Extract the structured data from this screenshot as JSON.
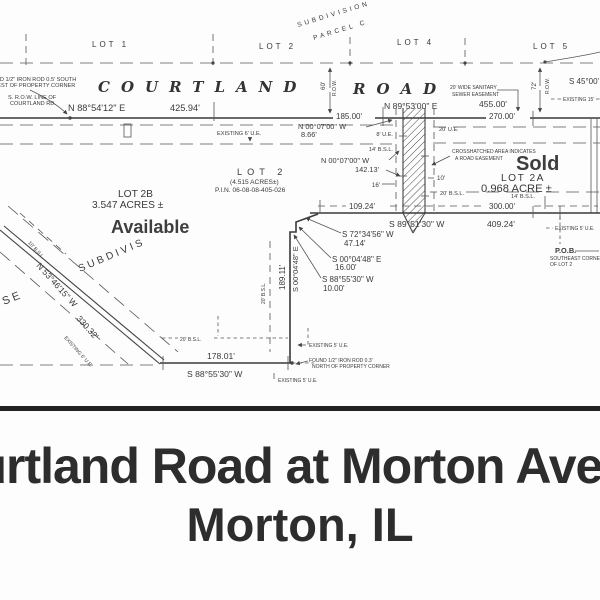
{
  "banner": {
    "line1": "Courtland Road at Morton Avenue",
    "line2": "Morton, IL"
  },
  "colors": {
    "ink": "#3a3a3a",
    "overlay_text": "#3e3e3e",
    "banner_text": "#2d2d2d",
    "paper": "#fdfdfd"
  },
  "plat": {
    "adjacent_lots": {
      "lot1": "LOT 1",
      "lot2": "LOT 2",
      "lot4": "LOT 4",
      "lot5": "LOT 5"
    },
    "subdivision_note": {
      "line1": "SUBDIVISION",
      "line2": "PARCEL C"
    },
    "road_name": {
      "left": "COURTLAND",
      "right": "ROAD"
    },
    "corner_note_nw": {
      "l1": "FOUND 1/2\" IRON ROD 0.5' SOUTH",
      "l2": "WEST OF PROPERTY CORNER",
      "l3": "S. R.O.W. LINE OF",
      "l4": "COURTLAND RD."
    },
    "row_dims": {
      "left_w": "60'",
      "left_t": "R.O.W.",
      "right_w": "72'",
      "right_t": "R.O.W."
    },
    "north_line": {
      "brg_left": "N 88°54'12\" E",
      "dist_left": "425.94'",
      "brg_right": "N 89°53'00\" E",
      "dist_right": "455.00'",
      "dist_185": "185.00'",
      "dist_270": "270.00'"
    },
    "se45": "S 45°00'",
    "existing_15": "EXISTING 15'",
    "sewer_easement": {
      "l1": "20' WIDE SANITARY",
      "l2": "SEWER EASEMENT"
    },
    "existing_6_top": "EXISTING 6' U.E.",
    "jog": {
      "brg": "N 00°07'00\" W",
      "dist": "8.66'"
    },
    "west_easement_line": {
      "brg": "N 00°07'00\" W",
      "dist": "142.13'"
    },
    "strip_labels": {
      "ue8": "8' U.E.",
      "bsl14_left": "14' B.S.L.",
      "ue20": "20' U.E.",
      "d10": "10'",
      "d16": "16'",
      "bsl20_right": "20' B.S.L."
    },
    "crosshatch_note": {
      "l1": "CROSSHATCHED AREA INDICATES",
      "l2": "A ROAD EASEMENT"
    },
    "lot2b": {
      "name": "LOT 2B",
      "acres": "3.547 ACRES ±",
      "status": "Available"
    },
    "lot2": {
      "name": "LOT 2",
      "acres": "(4.515 ACRES±)",
      "pin": "P.I.N. 06-08-08-405-026"
    },
    "lot2a": {
      "status": "Sold",
      "name": "LOT 2A",
      "acres": "0.968 ACRE ±",
      "bsl14": "14' B.S.L."
    },
    "south_line_2a": {
      "dist_109": "109.24'",
      "dist_300": "300.00'",
      "brg": "S 89°51'30\" W",
      "dist": "409.24'"
    },
    "existing_5_east": "EXISTING 5' U.E.",
    "pob": {
      "l1": "P.O.B.",
      "l2": "SOUTHEAST CORNER",
      "l3": "OF LOT 2"
    },
    "step_calls": [
      {
        "brg": "S 72°34'56\" W",
        "dist": "47.14'"
      },
      {
        "brg": "S 00°04'48\" E",
        "dist": "16.00'"
      },
      {
        "brg": "S 88°55'30\" W",
        "dist": "10.00'"
      }
    ],
    "west_line": {
      "dist": "189.11'",
      "brg": "S 00°04'48\" E",
      "bsl": "20' B.S.L."
    },
    "south_line_2b": {
      "dist": "178.01'",
      "brg": "S 88°55'30\" W",
      "bsl": "20' B.S.L."
    },
    "corner_note_s": {
      "ue_a": "EXISTING 5' U.E.",
      "rod1": "FOUND 1/2\" IRON ROD 0.3'",
      "rod2": "NORTH OF PROPERTY CORNER",
      "ue_b": "EXISTING 5' U.E."
    },
    "morton_ave": {
      "brg": "N 53°46'15\" W",
      "dist": "330.32'",
      "ue": "EXISTING 6' U.E.",
      "bsl": "10' B.S.L.",
      "word1": "SE",
      "word2": "SUBDIVIS"
    }
  }
}
